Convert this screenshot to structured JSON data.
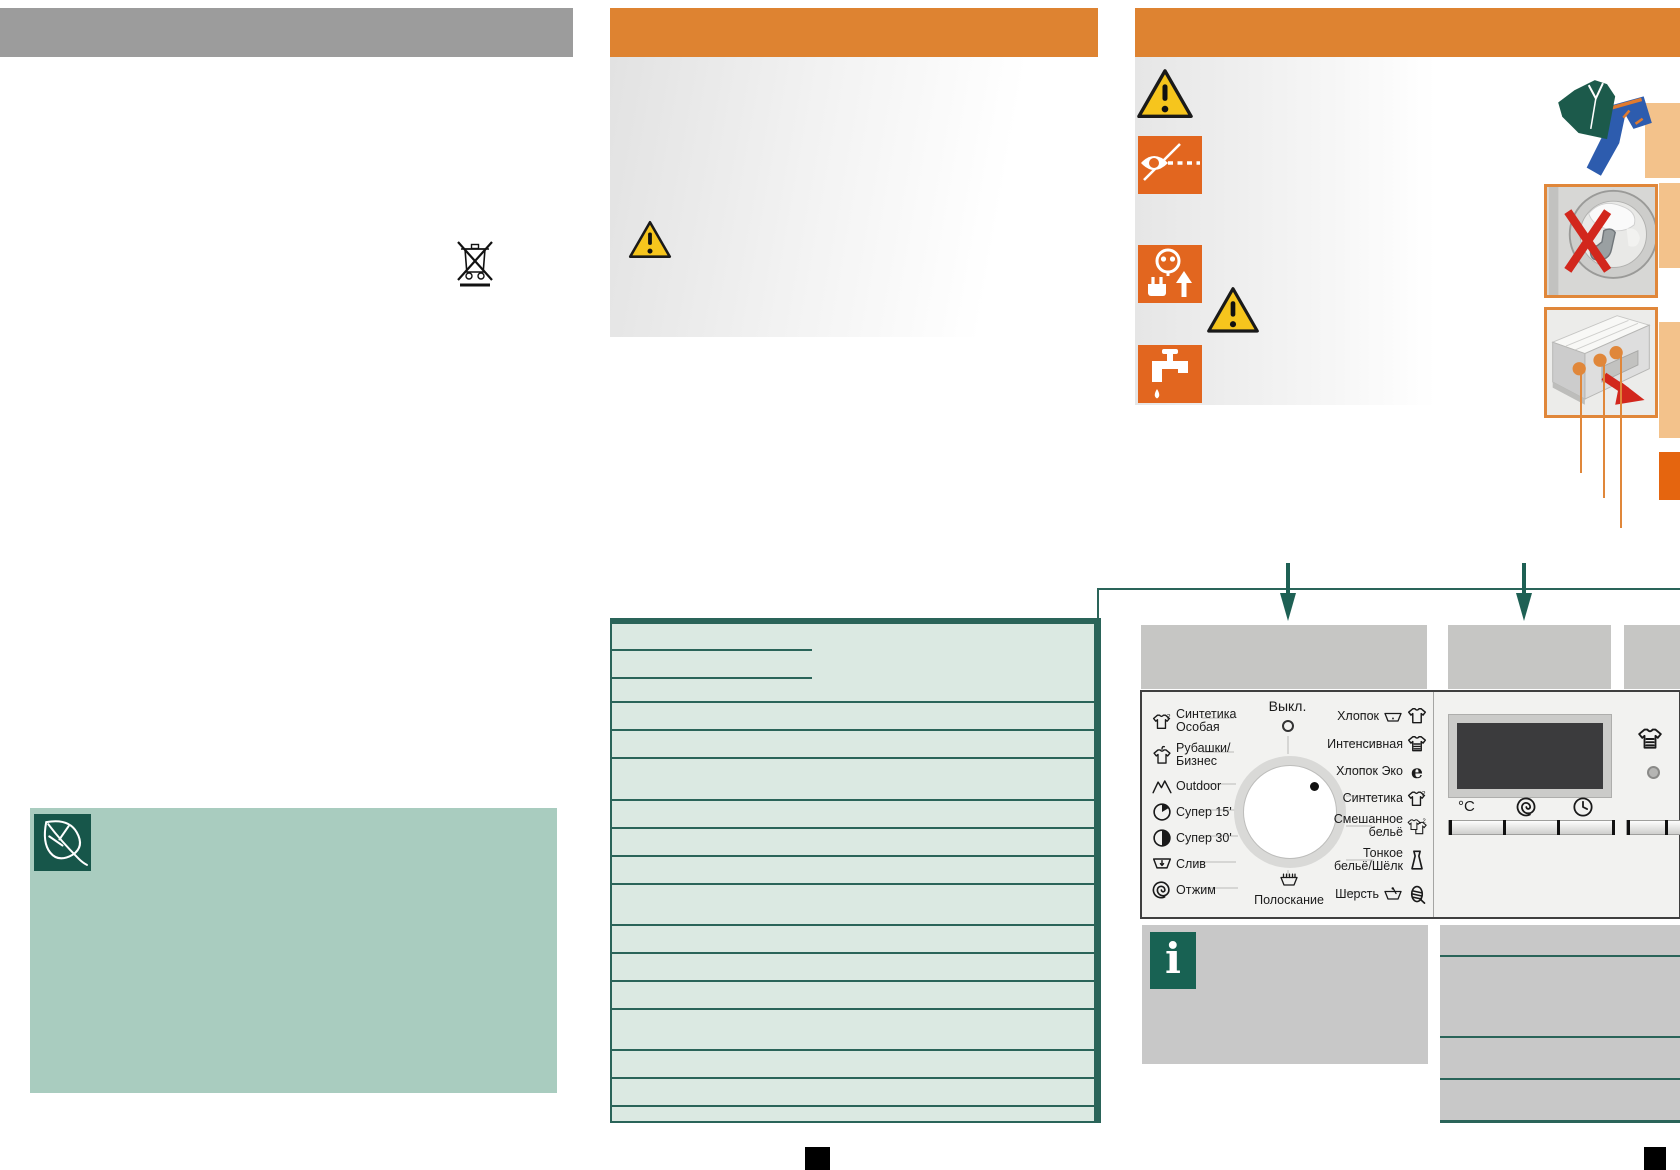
{
  "colors": {
    "orange_header": "#de8331",
    "orange_accent": "#e0873a",
    "orange_tab": "#e5650f",
    "peach_strip": "#f3c28b",
    "gray_header": "#9c9c9c",
    "caption_gray": "#c6c6c4",
    "mint_table": "#dbe9e2",
    "teal_dark": "#2a6459",
    "sage_green": "#a9ccbf",
    "dark_green": "#17564a",
    "info_green": "#186253",
    "warning_yellow": "#f6c51d",
    "icon_orange": "#e2661f",
    "alert_red": "#d2271d",
    "display_dark": "#3b3b3d"
  },
  "washer_panel": {
    "off_label": "Выкл.",
    "rinse_label": "Полоскание",
    "temperature_label": "°C",
    "left_programs": [
      {
        "label_lines": [
          "Синтетика",
          "Особая"
        ],
        "icon": "synthetics-special-icon"
      },
      {
        "label_lines": [
          "Рубашки/",
          "Бизнес"
        ],
        "icon": "shirts-business-icon"
      },
      {
        "label_lines": [
          "Outdoor"
        ],
        "icon": "outdoor-icon"
      },
      {
        "label_lines": [
          "Супер 15'"
        ],
        "icon": "super-15-icon"
      },
      {
        "label_lines": [
          "Супер 30'"
        ],
        "icon": "super-30-icon"
      },
      {
        "label_lines": [
          "Слив"
        ],
        "icon": "drain-icon"
      },
      {
        "label_lines": [
          "Отжим"
        ],
        "icon": "spin-icon"
      }
    ],
    "right_programs": [
      {
        "label_lines": [
          "Хлопок"
        ],
        "icons": [
          "wash-tub-icon",
          "tshirt-icon"
        ]
      },
      {
        "label_lines": [
          "Интенсивная"
        ],
        "icons": [
          "intensive-wash-icon"
        ]
      },
      {
        "label_lines": [
          "Хлопок Эко"
        ],
        "icons": [
          "eco-e-icon"
        ]
      },
      {
        "label_lines": [
          "Синтетика"
        ],
        "icons": [
          "synthetics-icon"
        ]
      },
      {
        "label_lines": [
          "Смешанное",
          "бельё"
        ],
        "icons": [
          "mixed-laundry-icon"
        ]
      },
      {
        "label_lines": [
          "Тонкое",
          "бельё/Шёлк"
        ],
        "icons": [
          "delicates-silk-icon"
        ]
      },
      {
        "label_lines": [
          "Шерсть"
        ],
        "icons": [
          "handwash-icon",
          "wool-icon"
        ]
      }
    ],
    "display_row_icons": [
      "spin-speed-icon",
      "finish-time-icon"
    ],
    "right_side_icon": "intensive-wash-icon"
  },
  "info_box": {
    "glyph": "i"
  },
  "eco_box": {
    "icon": "leaf-icon"
  },
  "safety_column_icons": [
    "warning-triangle-icon",
    "supervision-eye-icon",
    "unplug-icon",
    "warning-triangle-icon",
    "water-tap-off-icon"
  ],
  "disposal_icon": "weee-crossed-bin-icon",
  "illustrations": [
    "clothes-illustration",
    "no-foreign-objects-drum-image",
    "detergent-drawer-image"
  ]
}
